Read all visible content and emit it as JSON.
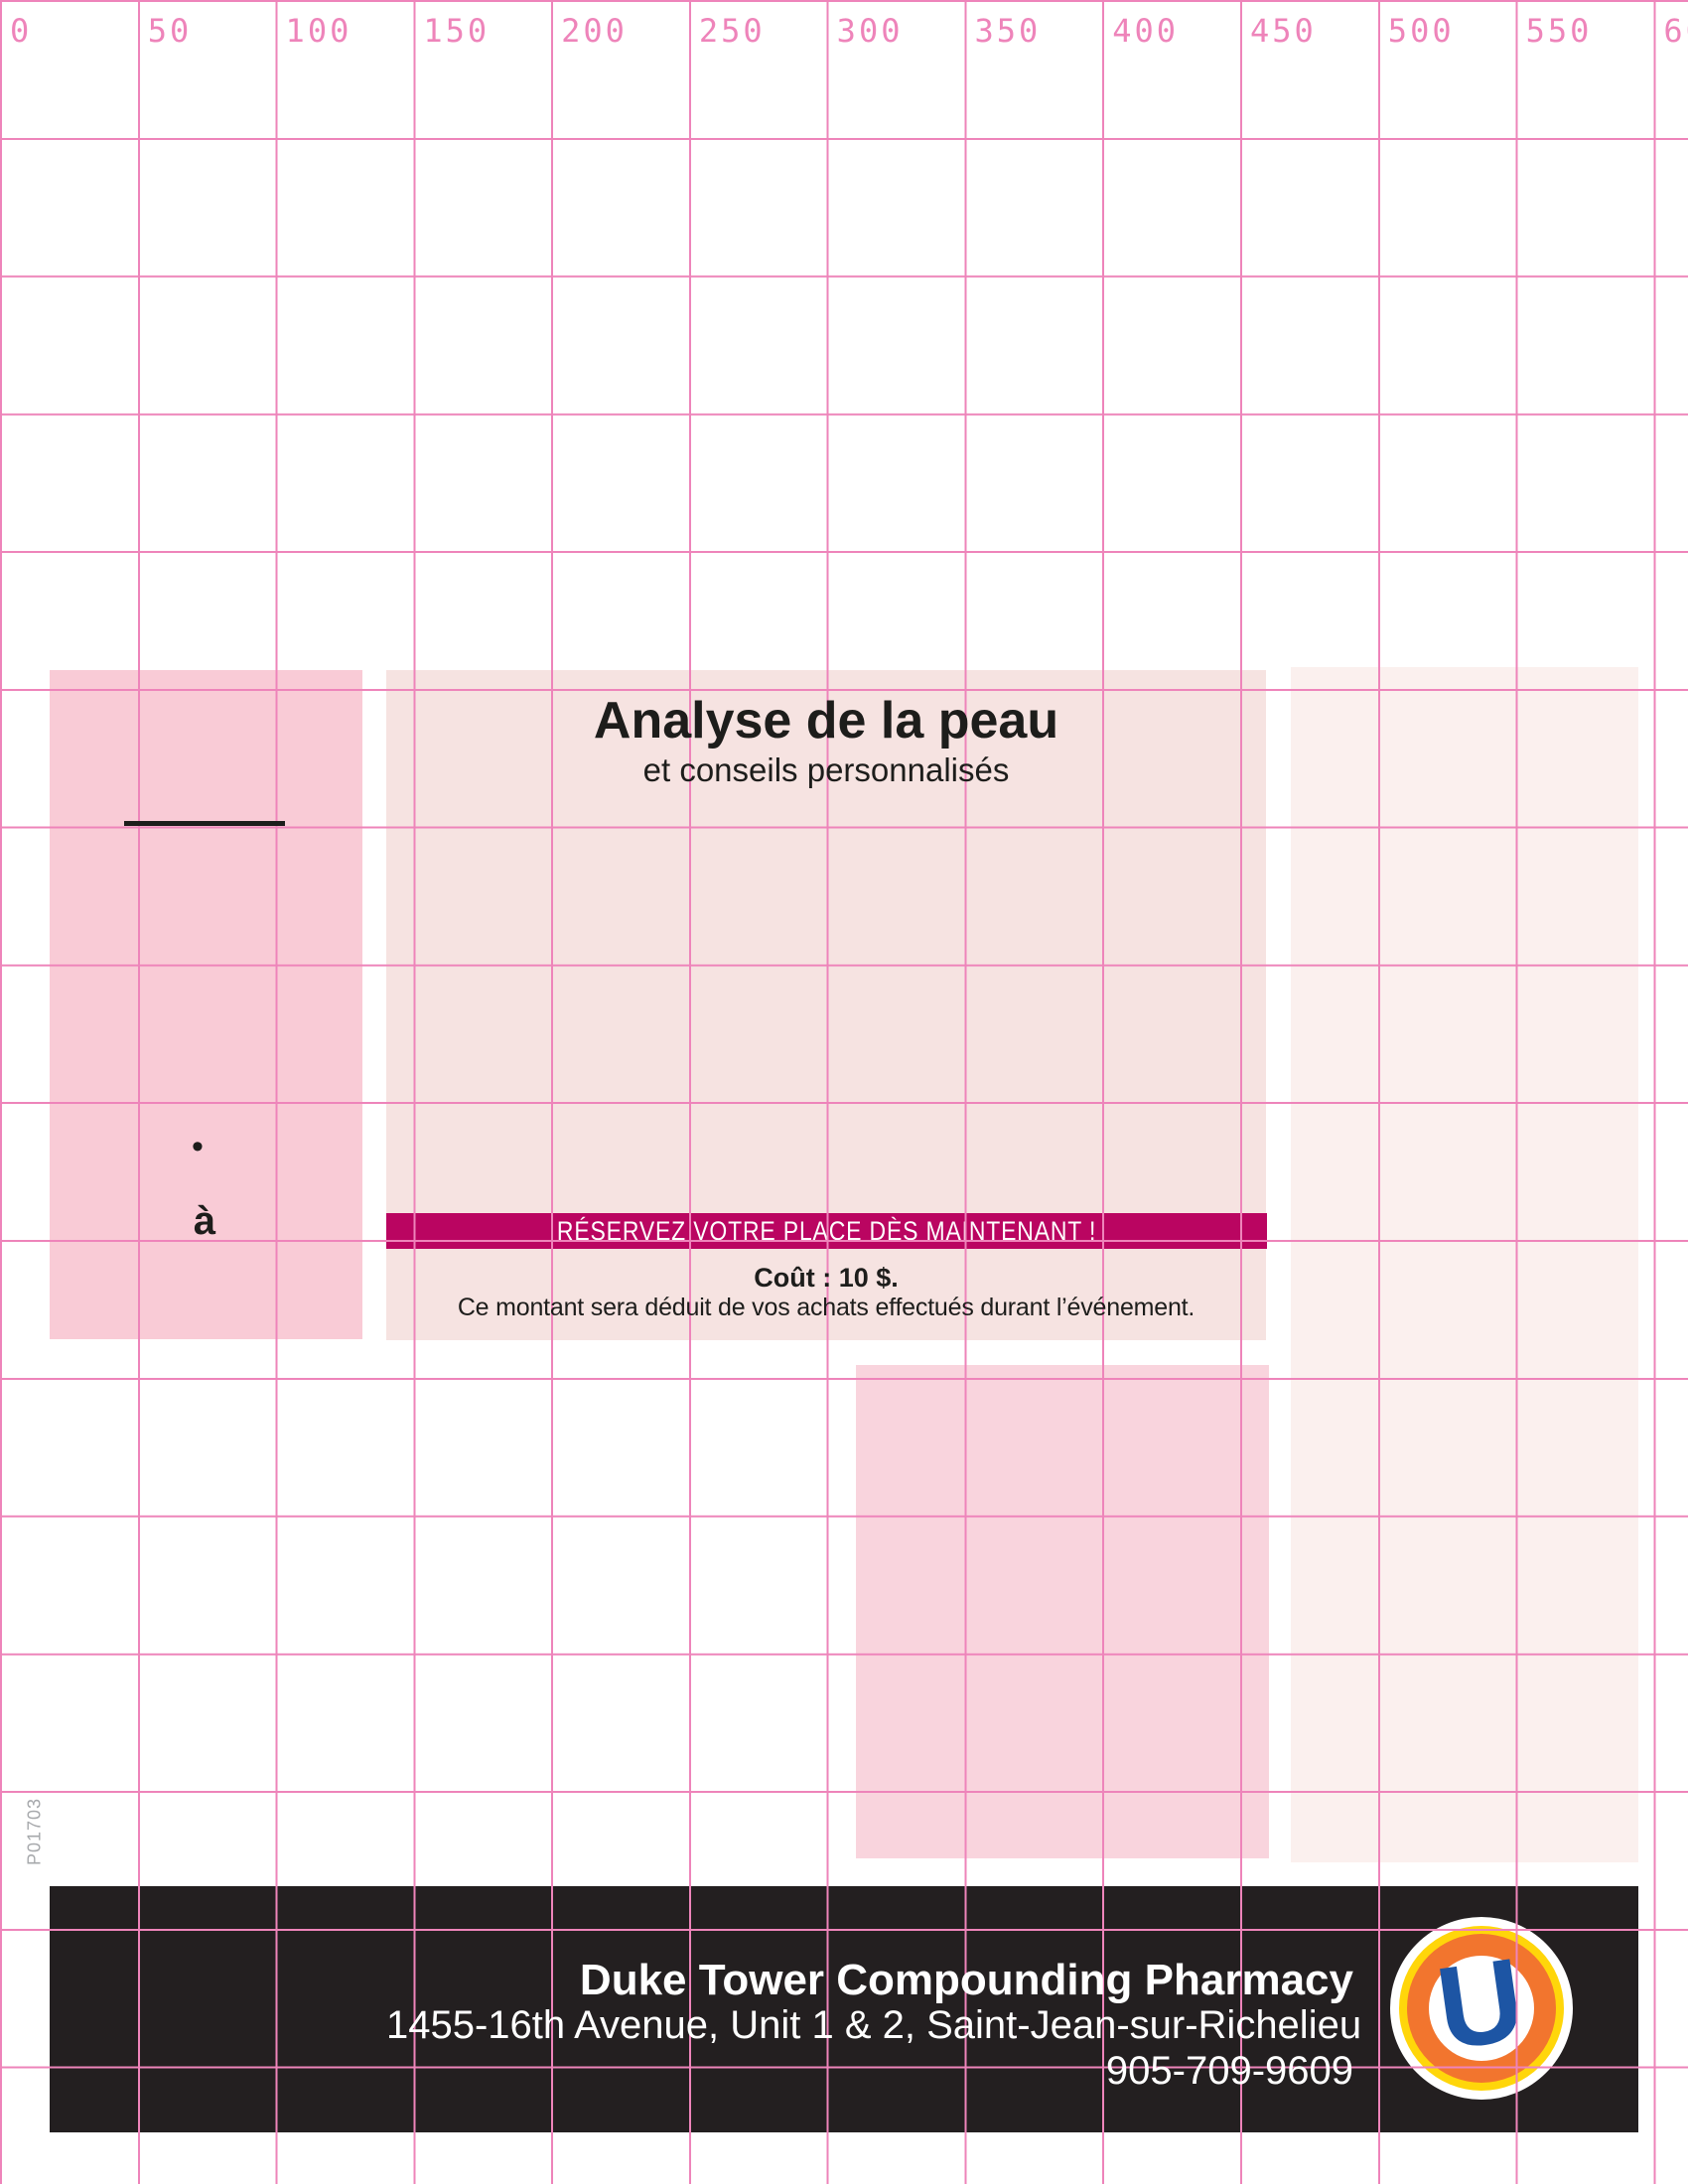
{
  "ruler": {
    "labels": [
      "0",
      "50",
      "100",
      "150",
      "200",
      "250",
      "300",
      "350",
      "400",
      "450",
      "500",
      "550",
      "600"
    ]
  },
  "slug": "P01703",
  "poster": {
    "title": "Analyse de la peau",
    "subtitle": "et conseils personnalisés",
    "bullet": "•",
    "a_label": "à",
    "banner": "RÉSERVEZ VOTRE PLACE DÈS MAINTENANT !",
    "cost": "Coût : 10 $.",
    "note": "Ce montant sera déduit de vos achats effectués durant l’événement."
  },
  "footer": {
    "name": "Duke Tower Compounding Pharmacy",
    "address": "1455-16th Avenue, Unit 1 & 2, Saint-Jean-sur-Richelieu",
    "phone": "905-709-9609",
    "logo_letter": "U"
  },
  "colors": {
    "grid": "#ee84ba",
    "ruler-text": "#ee84ba",
    "block-left": "#f9cbd6",
    "block-center": "#f6e3e1",
    "block-right": "#fbf0ee",
    "block-lower": "#f9d4dd",
    "banner": "#ba0561",
    "footer-bg": "#231f20",
    "logo-yellow": "#ffd60a",
    "logo-orange": "#f2752e",
    "logo-blue": "#1d55a4",
    "slug-text": "#a6a8ab",
    "text-dark": "#1d1d1b"
  }
}
